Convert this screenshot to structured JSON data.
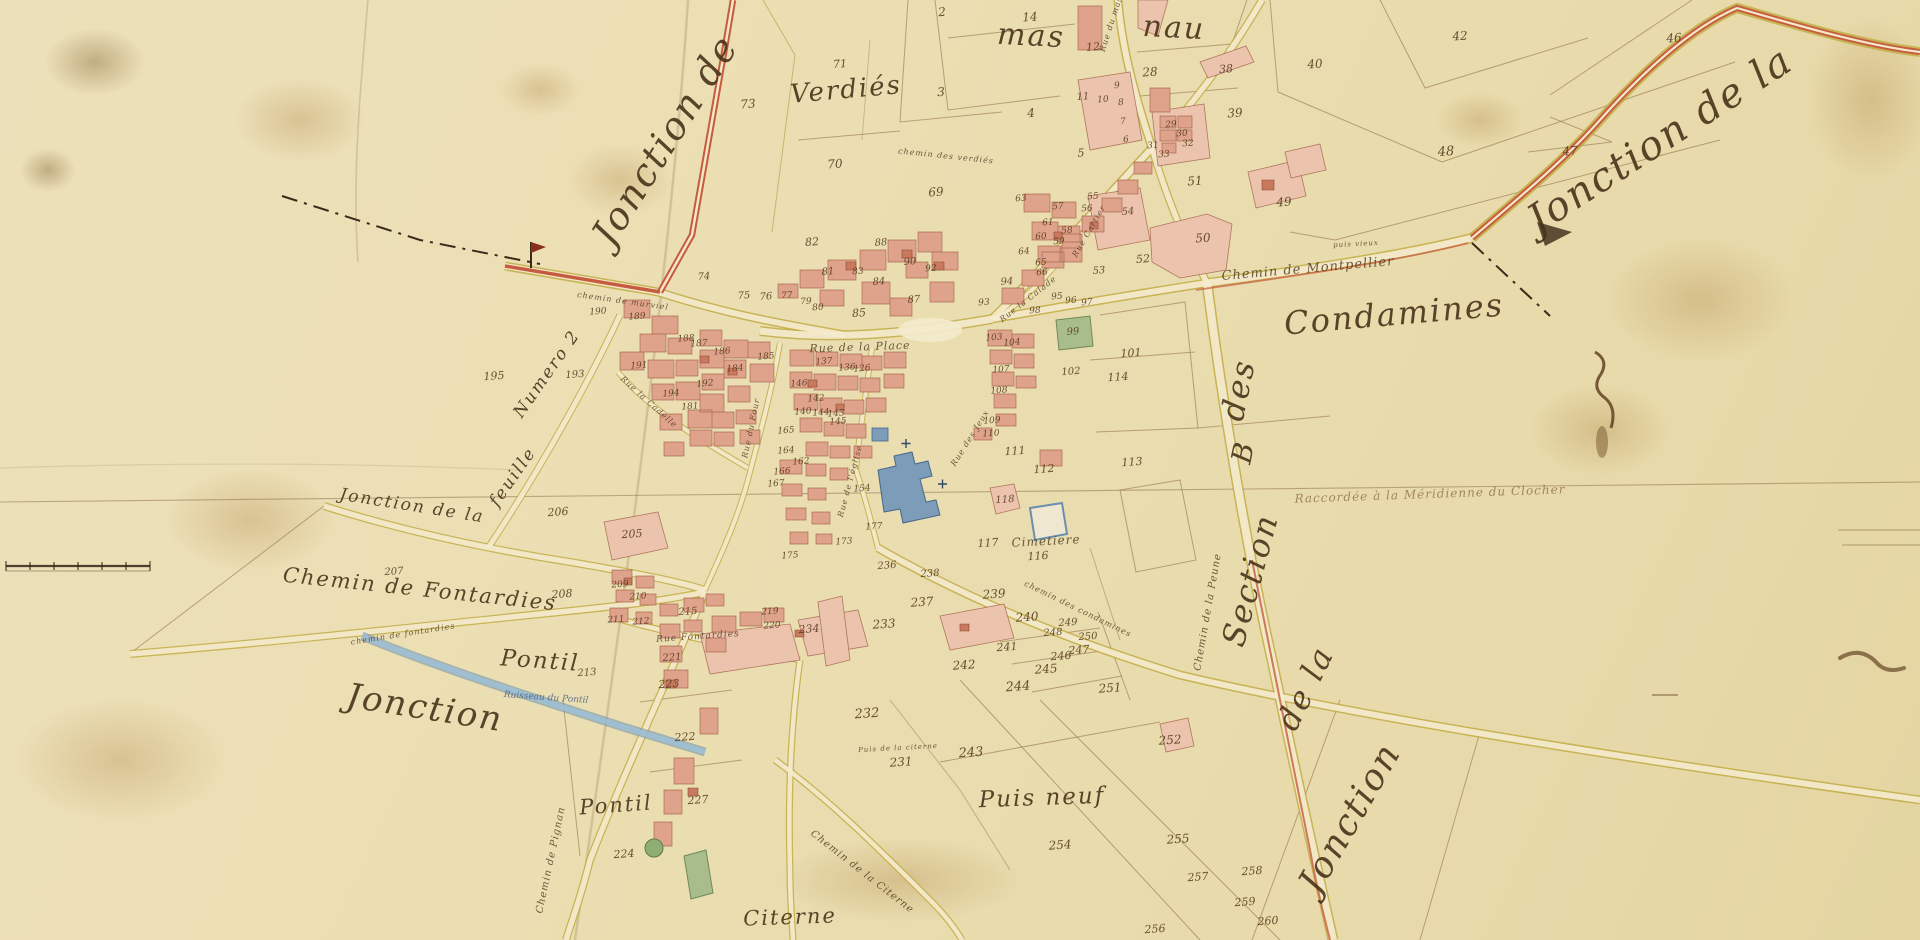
{
  "map": {
    "palette": {
      "parchment": "#ecdfb4",
      "building_pink": "#dfa28a",
      "building_light": "#ecc4ae",
      "building_red": "#c97a5e",
      "road_yellow": "#c2ad45",
      "road_red": "#c75b40",
      "water_blue": "#8fb0c8",
      "garden_green": "#a9bd8c",
      "ink_brown": "#49331a"
    },
    "features": [
      {
        "name": "church-blue-building",
        "color": "#7d9cb8"
      },
      {
        "name": "cemetery-walled-square",
        "color": "#6a8fae"
      },
      {
        "name": "stream-ruisseau",
        "color": "#8fb0c8"
      },
      {
        "name": "garden-parcels-green",
        "color": "#a9bd8c"
      },
      {
        "name": "section-boundary-dash-dot",
        "color": "#3a2a18"
      },
      {
        "name": "scale-bar",
        "color": "#2f2415"
      }
    ],
    "region_labels": [
      {
        "t": "Jonction de",
        "x": 665,
        "y": 140,
        "s": 38,
        "r": -58
      },
      {
        "t": "Verdiés",
        "x": 846,
        "y": 90,
        "s": 26,
        "r": -5
      },
      {
        "t": "mas",
        "x": 1031,
        "y": 36,
        "s": 30,
        "r": 3
      },
      {
        "t": "nau",
        "x": 1174,
        "y": 28,
        "s": 30,
        "r": 3
      },
      {
        "t": "Jonction de la",
        "x": 1660,
        "y": 140,
        "s": 40,
        "r": -33
      },
      {
        "t": "Condamines",
        "x": 1394,
        "y": 314,
        "s": 32,
        "r": -5
      },
      {
        "t": "des",
        "x": 1238,
        "y": 390,
        "s": 32,
        "r": -78
      },
      {
        "t": "B",
        "x": 1243,
        "y": 452,
        "s": 28,
        "r": -78
      },
      {
        "t": "Section",
        "x": 1250,
        "y": 580,
        "s": 32,
        "r": -75
      },
      {
        "t": "de la",
        "x": 1305,
        "y": 688,
        "s": 32,
        "r": -64
      },
      {
        "t": "Jonction",
        "x": 1350,
        "y": 818,
        "s": 36,
        "r": -60
      },
      {
        "t": "Jonction",
        "x": 425,
        "y": 708,
        "s": 34,
        "r": 9
      },
      {
        "t": "Chemin de Fontardies",
        "x": 420,
        "y": 589,
        "s": 21,
        "r": 6
      },
      {
        "t": "Pontil",
        "x": 540,
        "y": 661,
        "s": 23,
        "r": 4
      },
      {
        "t": "Pontil",
        "x": 616,
        "y": 805,
        "s": 21,
        "r": -4
      },
      {
        "t": "Puis neuf",
        "x": 1042,
        "y": 798,
        "s": 23,
        "r": -2
      },
      {
        "t": "Citerne",
        "x": 790,
        "y": 917,
        "s": 21,
        "r": -2
      },
      {
        "t": "Jonction de la",
        "x": 412,
        "y": 506,
        "s": 17,
        "r": 9
      },
      {
        "t": "feuille",
        "x": 513,
        "y": 477,
        "s": 17,
        "r": -55
      },
      {
        "t": "Numero 2",
        "x": 547,
        "y": 374,
        "s": 17,
        "r": -55
      }
    ],
    "road_labels": [
      {
        "t": "Chemin de Montpellier",
        "x": 1308,
        "y": 269,
        "s": 13,
        "r": -5
      },
      {
        "t": "chemin des verdiés",
        "x": 946,
        "y": 156,
        "s": 8,
        "r": 6
      },
      {
        "t": "Rue du mas",
        "x": 1111,
        "y": 24,
        "s": 8,
        "r": -72
      },
      {
        "t": "chemin de murviel",
        "x": 623,
        "y": 301,
        "s": 8,
        "r": 8
      },
      {
        "t": "Rue de la Place",
        "x": 860,
        "y": 347,
        "s": 11,
        "r": -2
      },
      {
        "t": "Rue Cartier",
        "x": 1089,
        "y": 231,
        "s": 8,
        "r": -60
      },
      {
        "t": "Rue la Calade",
        "x": 1028,
        "y": 299,
        "s": 8,
        "r": -38
      },
      {
        "t": "Rue la Cadelle",
        "x": 649,
        "y": 402,
        "s": 8,
        "r": 42
      },
      {
        "t": "Rue du Four",
        "x": 751,
        "y": 428,
        "s": 8,
        "r": -78
      },
      {
        "t": "Rue de l'église",
        "x": 850,
        "y": 481,
        "s": 8,
        "r": -75
      },
      {
        "t": "Rue des Jeux",
        "x": 970,
        "y": 438,
        "s": 8,
        "r": -58
      },
      {
        "t": "Rue Fontardies",
        "x": 698,
        "y": 637,
        "s": 9,
        "r": -4
      },
      {
        "t": "chemin de fontardies",
        "x": 403,
        "y": 634,
        "s": 8,
        "r": -9
      },
      {
        "t": "Chemin de Pignan",
        "x": 551,
        "y": 860,
        "s": 10,
        "r": -78
      },
      {
        "t": "Chemin de la Citerne",
        "x": 862,
        "y": 872,
        "s": 10,
        "r": 38
      },
      {
        "t": "Chemin de la Peune",
        "x": 1208,
        "y": 612,
        "s": 10,
        "r": -80
      },
      {
        "t": "chemin des condamines",
        "x": 1078,
        "y": 609,
        "s": 8,
        "r": 26
      },
      {
        "t": "Puis de la citerne",
        "x": 898,
        "y": 748,
        "s": 7,
        "r": -3
      },
      {
        "t": "puis vieux",
        "x": 1356,
        "y": 244,
        "s": 7,
        "r": -3
      },
      {
        "t": "Cimetiere",
        "x": 1046,
        "y": 541,
        "s": 12,
        "r": -3
      }
    ],
    "water_labels": [
      {
        "t": "Ruisseau du Pontil",
        "x": 546,
        "y": 698,
        "s": 9,
        "r": 4
      }
    ],
    "annotations": [
      {
        "t": "Raccordée à la Méridienne du Clocher",
        "x": 1430,
        "y": 494,
        "s": 12,
        "r": -2
      }
    ],
    "parcel_numbers": [
      [
        2,
        942,
        12,
        12
      ],
      [
        14,
        1030,
        17,
        12
      ],
      [
        12,
        1093,
        47,
        11
      ],
      [
        3,
        941,
        92,
        12
      ],
      [
        4,
        1031,
        113,
        12
      ],
      [
        5,
        1081,
        153,
        11
      ],
      [
        6,
        1126,
        140,
        9
      ],
      [
        7,
        1123,
        122,
        9
      ],
      [
        8,
        1121,
        103,
        9
      ],
      [
        9,
        1117,
        86,
        9
      ],
      [
        10,
        1103,
        100,
        9
      ],
      [
        11,
        1083,
        97,
        10
      ],
      [
        28,
        1150,
        72,
        12
      ],
      [
        29,
        1171,
        125,
        9
      ],
      [
        30,
        1182,
        134,
        9
      ],
      [
        31,
        1153,
        146,
        9
      ],
      [
        32,
        1188,
        144,
        9
      ],
      [
        33,
        1164,
        155,
        9
      ],
      [
        38,
        1226,
        69,
        11
      ],
      [
        39,
        1235,
        113,
        12
      ],
      [
        40,
        1315,
        64,
        12
      ],
      [
        42,
        1460,
        36,
        12
      ],
      [
        46,
        1674,
        38,
        12
      ],
      [
        47,
        1570,
        151,
        12
      ],
      [
        48,
        1446,
        152,
        13
      ],
      [
        49,
        1284,
        202,
        12
      ],
      [
        50,
        1203,
        238,
        12
      ],
      [
        51,
        1195,
        181,
        12
      ],
      [
        52,
        1143,
        259,
        11
      ],
      [
        53,
        1099,
        271,
        10
      ],
      [
        54,
        1128,
        212,
        10
      ],
      [
        55,
        1093,
        197,
        9
      ],
      [
        56,
        1087,
        209,
        9
      ],
      [
        57,
        1058,
        207,
        9
      ],
      [
        58,
        1067,
        231,
        9
      ],
      [
        59,
        1059,
        242,
        9
      ],
      [
        60,
        1041,
        237,
        9
      ],
      [
        61,
        1048,
        223,
        9
      ],
      [
        63,
        1021,
        199,
        9
      ],
      [
        64,
        1024,
        252,
        9
      ],
      [
        65,
        1041,
        263,
        9
      ],
      [
        66,
        1042,
        273,
        9
      ],
      [
        69,
        936,
        192,
        12
      ],
      [
        70,
        835,
        164,
        12
      ],
      [
        71,
        840,
        64,
        11
      ],
      [
        73,
        748,
        104,
        12
      ],
      [
        74,
        704,
        277,
        10
      ],
      [
        75,
        744,
        296,
        10
      ],
      [
        76,
        766,
        297,
        10
      ],
      [
        77,
        787,
        296,
        9
      ],
      [
        79,
        806,
        302,
        9
      ],
      [
        80,
        818,
        308,
        9
      ],
      [
        81,
        828,
        272,
        10
      ],
      [
        82,
        812,
        242,
        11
      ],
      [
        83,
        858,
        272,
        9
      ],
      [
        84,
        879,
        282,
        10
      ],
      [
        85,
        859,
        313,
        11
      ],
      [
        87,
        914,
        300,
        10
      ],
      [
        88,
        881,
        243,
        10
      ],
      [
        90,
        910,
        262,
        10
      ],
      [
        92,
        931,
        269,
        9
      ],
      [
        93,
        984,
        303,
        9
      ],
      [
        94,
        1007,
        282,
        10
      ],
      [
        95,
        1057,
        297,
        9
      ],
      [
        96,
        1071,
        301,
        9
      ],
      [
        97,
        1087,
        303,
        9
      ],
      [
        98,
        1035,
        311,
        9
      ],
      [
        99,
        1073,
        332,
        10
      ],
      [
        101,
        1131,
        353,
        11
      ],
      [
        102,
        1071,
        372,
        10
      ],
      [
        103,
        994,
        338,
        9
      ],
      [
        104,
        1012,
        343,
        9
      ],
      [
        107,
        1001,
        370,
        9
      ],
      [
        108,
        999,
        391,
        9
      ],
      [
        109,
        992,
        421,
        9
      ],
      [
        110,
        991,
        434,
        9
      ],
      [
        111,
        1015,
        451,
        11
      ],
      [
        112,
        1044,
        469,
        11
      ],
      [
        113,
        1132,
        462,
        11
      ],
      [
        114,
        1118,
        377,
        11
      ],
      [
        116,
        1038,
        556,
        11
      ],
      [
        117,
        988,
        543,
        11
      ],
      [
        118,
        1005,
        500,
        10
      ],
      [
        126,
        862,
        369,
        9
      ],
      [
        136,
        847,
        368,
        9
      ],
      [
        137,
        824,
        362,
        9
      ],
      [
        140,
        803,
        412,
        9
      ],
      [
        142,
        816,
        399,
        9
      ],
      [
        143,
        836,
        414,
        9
      ],
      [
        144,
        821,
        413,
        9
      ],
      [
        145,
        838,
        422,
        9
      ],
      [
        146,
        799,
        384,
        9
      ],
      [
        154,
        862,
        489,
        9
      ],
      [
        162,
        801,
        462,
        9
      ],
      [
        164,
        786,
        451,
        9
      ],
      [
        165,
        786,
        431,
        9
      ],
      [
        166,
        782,
        472,
        9
      ],
      [
        167,
        776,
        484,
        9
      ],
      [
        173,
        844,
        542,
        9
      ],
      [
        175,
        790,
        556,
        9
      ],
      [
        177,
        874,
        527,
        9
      ],
      [
        181,
        690,
        407,
        9
      ],
      [
        184,
        735,
        369,
        9
      ],
      [
        185,
        766,
        357,
        9
      ],
      [
        186,
        722,
        352,
        9
      ],
      [
        187,
        699,
        344,
        9
      ],
      [
        188,
        686,
        339,
        9
      ],
      [
        189,
        637,
        317,
        9
      ],
      [
        190,
        598,
        312,
        9
      ],
      [
        191,
        639,
        366,
        9
      ],
      [
        192,
        705,
        384,
        9
      ],
      [
        193,
        575,
        375,
        10
      ],
      [
        194,
        671,
        394,
        9
      ],
      [
        195,
        494,
        376,
        11
      ],
      [
        205,
        632,
        534,
        11
      ],
      [
        206,
        558,
        512,
        11
      ],
      [
        207,
        394,
        572,
        10
      ],
      [
        208,
        562,
        594,
        11
      ],
      [
        209,
        620,
        585,
        9
      ],
      [
        210,
        638,
        597,
        9
      ],
      [
        211,
        616,
        620,
        9
      ],
      [
        212,
        641,
        622,
        9
      ],
      [
        213,
        587,
        673,
        10
      ],
      [
        215,
        688,
        612,
        10
      ],
      [
        219,
        770,
        612,
        9
      ],
      [
        220,
        772,
        626,
        9
      ],
      [
        221,
        672,
        658,
        10
      ],
      [
        222,
        685,
        737,
        11
      ],
      [
        223,
        669,
        684,
        11
      ],
      [
        224,
        624,
        854,
        11
      ],
      [
        227,
        698,
        800,
        11
      ],
      [
        231,
        901,
        762,
        12
      ],
      [
        232,
        867,
        714,
        13
      ],
      [
        233,
        884,
        624,
        12
      ],
      [
        234,
        809,
        629,
        11
      ],
      [
        236,
        887,
        566,
        10
      ],
      [
        237,
        922,
        602,
        12
      ],
      [
        238,
        930,
        574,
        10
      ],
      [
        239,
        994,
        594,
        12
      ],
      [
        240,
        1027,
        617,
        12
      ],
      [
        241,
        1007,
        647,
        11
      ],
      [
        242,
        964,
        665,
        12
      ],
      [
        243,
        971,
        753,
        13
      ],
      [
        244,
        1018,
        687,
        13
      ],
      [
        245,
        1046,
        669,
        12
      ],
      [
        246,
        1061,
        656,
        11
      ],
      [
        247,
        1079,
        650,
        11
      ],
      [
        248,
        1053,
        633,
        10
      ],
      [
        249,
        1068,
        623,
        10
      ],
      [
        250,
        1088,
        637,
        10
      ],
      [
        251,
        1110,
        688,
        12
      ],
      [
        252,
        1170,
        740,
        12
      ],
      [
        254,
        1060,
        845,
        12
      ],
      [
        255,
        1178,
        839,
        12
      ],
      [
        256,
        1155,
        929,
        11
      ],
      [
        257,
        1198,
        877,
        11
      ],
      [
        258,
        1252,
        871,
        11
      ],
      [
        259,
        1245,
        902,
        11
      ],
      [
        260,
        1268,
        921,
        11
      ]
    ]
  }
}
